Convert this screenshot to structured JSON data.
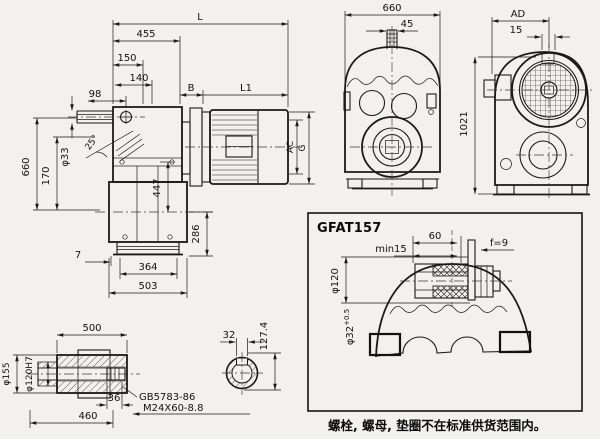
{
  "note": "螺栓, 螺母, 垫圈不在标准供货范围内。",
  "side_view": {
    "dims": {
      "L": "L",
      "d455": "455",
      "d150": "150",
      "d140": "140",
      "d98": "98",
      "B": "B",
      "L1": "L1",
      "v660": "660",
      "v170": "170",
      "dia33": "φ33",
      "ang25": "25°",
      "v447": "447",
      "v286": "286",
      "d7": "7",
      "d364": "364",
      "d503": "503",
      "AC": "AC",
      "G": "G"
    }
  },
  "front_view": {
    "dims": {
      "w660": "660",
      "w45": "45"
    }
  },
  "end_view": {
    "dims": {
      "AD": "AD",
      "w15": "15",
      "h1021": "1021"
    }
  },
  "detail_view": {
    "title": "GFAT157",
    "dims": {
      "d60": "60",
      "min15": "min15",
      "f9": "f=9",
      "dia120": "φ120",
      "dia32": "φ32",
      "dia32tol": "+0.5"
    }
  },
  "hollow_shaft": {
    "dims": {
      "d500": "500",
      "dia155": "φ155",
      "dia120h7": "φ120H7",
      "d36": "36",
      "d460": "460"
    },
    "labels": {
      "std": "GB5783-86",
      "spec": "M24X60-8.8"
    }
  },
  "shaft_section": {
    "dims": {
      "d32": "32",
      "d1274": "127.4"
    }
  }
}
